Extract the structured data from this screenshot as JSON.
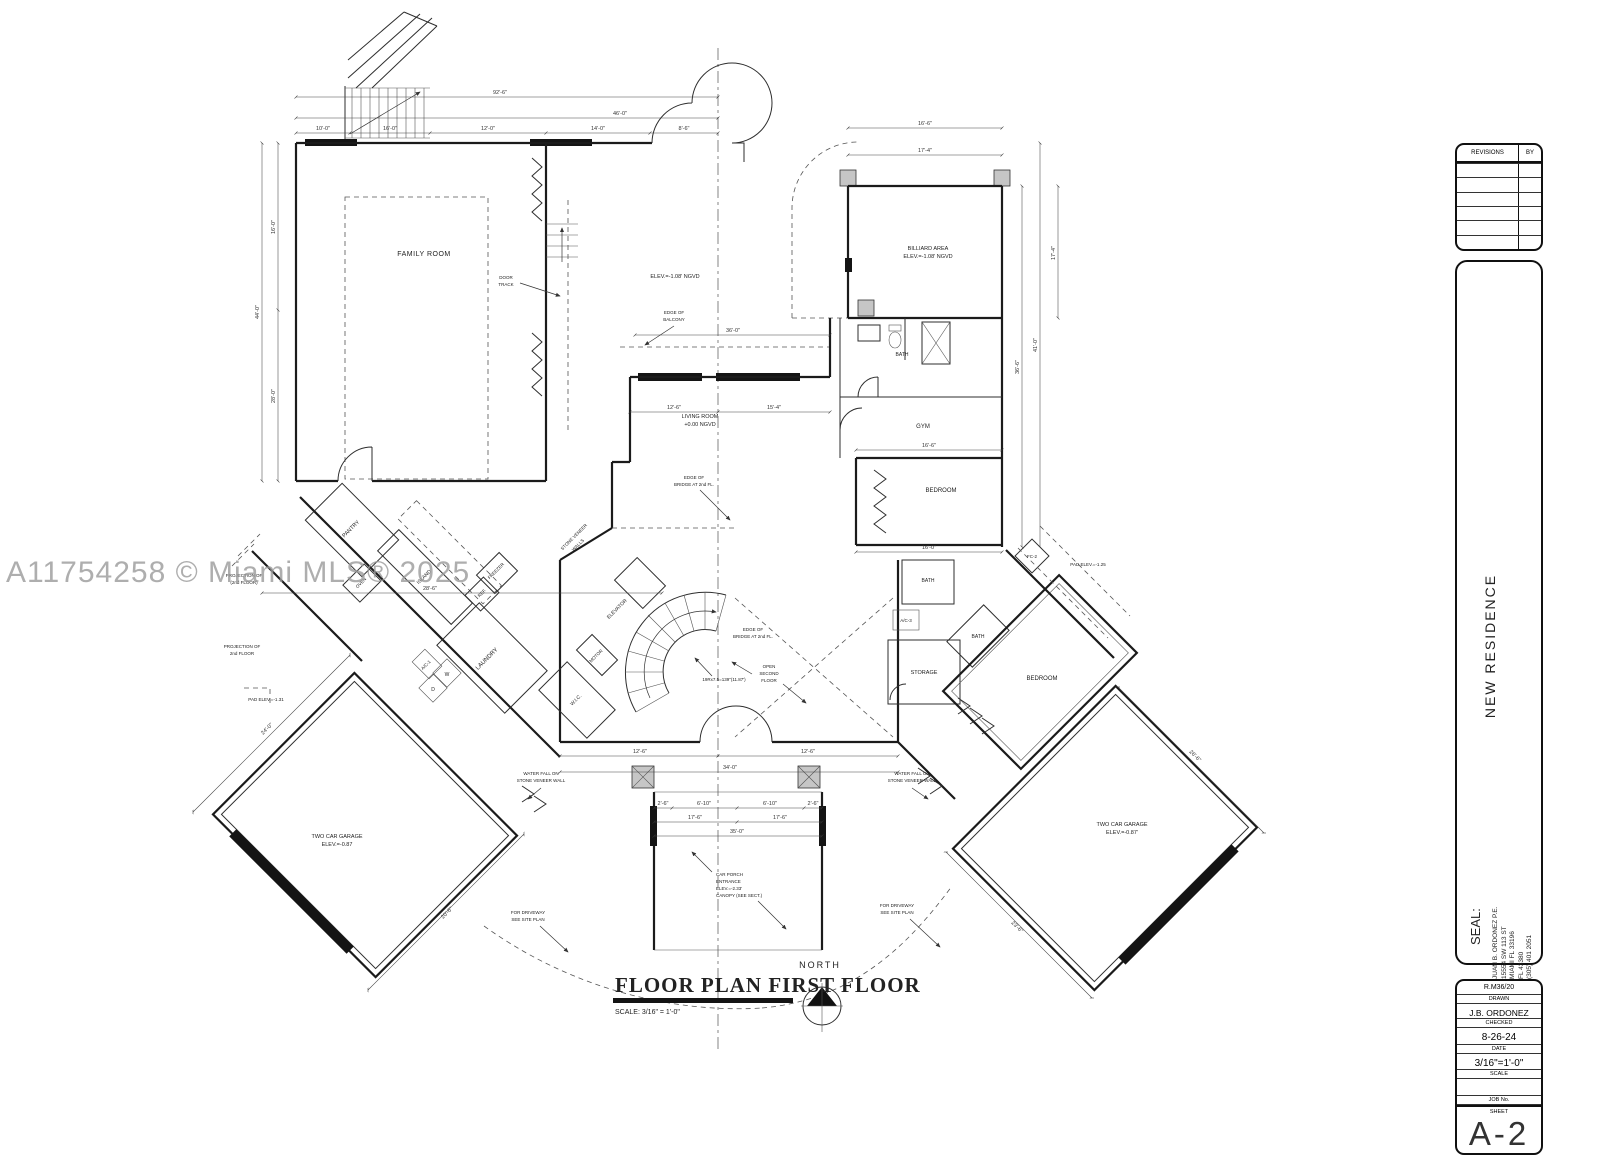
{
  "watermark": "A11754258 © Miami MLS® 2025",
  "plan_title": {
    "main": "FLOOR PLAN FIRST FLOOR",
    "scale": "SCALE: 3/16\" = 1'-0\"",
    "north": "NORTH"
  },
  "titleblock": {
    "revisions_label": "REVISIONS",
    "by_label": "BY",
    "project_name": "NEW RESIDENCE",
    "seal_label": "SEAL:",
    "engineer_lines": [
      "JUAN B. ORDONEZ P.E.",
      "15554 SW 113 ST",
      "MIAMI FL 33196",
      "FL 43380",
      "(305) 401 2051"
    ],
    "drawn_value": "R.M36/20",
    "drawn_label": "DRAWN",
    "checked_value": "J.B. ORDONEZ",
    "checked_label": "CHECKED",
    "date_value": "8-26-24",
    "date_label": "DATE",
    "scale_value": "3/16\"=1'-0\"",
    "scale_label": "SCALE",
    "job_label": "JOB No.",
    "sheet_label": "SHEET",
    "sheet_value": "A-2"
  },
  "rooms": {
    "family": "FAMILY ROOM",
    "living": [
      "LIVING ROOM",
      "+0.00 NGVD"
    ],
    "billiard": [
      "BILLIARD AREA",
      "ELEV.=-1.08' NGVD"
    ],
    "balcony_elev": "ELEV.=-1.08' NGVD",
    "gym": "GYM",
    "bedroom_right": "BEDROOM",
    "bedroom_wing": "BEDROOM",
    "storage": "STORAGE",
    "bath": "BATH",
    "pantry": "PANTRY",
    "island": "ISLAND",
    "oven": "OVEN",
    "freezer": "FREEZER",
    "fridge": "REF.",
    "laundry": "LAUNDRY",
    "wic": "W.I.C.",
    "elevator": "ELEVATOR",
    "motor": "MOTOR",
    "washer": "W",
    "dryer": "D",
    "ac1": "A/C-1",
    "ac3": "A/C-3",
    "fc2": "FC-2",
    "garage_left": [
      "TWO CAR GARAGE",
      "ELEV.=-0.87"
    ],
    "garage_right": [
      "TWO CAR GARAGE",
      "ELEV.=-0.87'"
    ]
  },
  "notes": {
    "door_track": [
      "DOOR",
      "TRACK"
    ],
    "edge_balcony": [
      "EDGE OF",
      "BALCONY"
    ],
    "edge_bridge": [
      "EDGE OF",
      "BRIDGE AT 2nd FL."
    ],
    "open_second": [
      "OPEN",
      "SECOND",
      "FLOOR"
    ],
    "stair_formula": "19Rx7.5=139\"(11.87')",
    "stone_veneer": [
      "STONE VENEER",
      "WALLS"
    ],
    "projection_paren": [
      "PROJECTION OF",
      "(2nd FLOOR)"
    ],
    "projection": [
      "PROJECTION OF",
      "2nd FLOOR"
    ],
    "pad_125": "PAD ELEV.=-1.25",
    "pad_131": "PAD ELEV.=-1.31",
    "waterfall": [
      "WATER FALL ON",
      "STONE VENEER WALL"
    ],
    "driveway": [
      "FOR DRIVEWAY",
      "SEE SITE PLAN"
    ],
    "car_porch": [
      "CAR PORCH",
      "ENTRANCE",
      "ELEV.=-2.33'",
      "CANOPY (SEE SECT.)"
    ]
  },
  "dims": [
    "92'-6\"",
    "46'-0\"",
    "10'-0\"",
    "16'-0\"",
    "12'-0\"",
    "14'-0\"",
    "8'-6\"",
    "16'-6\"",
    "17'-4\"",
    "44'-0\"",
    "16'-0\"",
    "28'-0\"",
    "36'-0\"",
    "12'-6\"",
    "15'-4\"",
    "36'-6\"",
    "41'-0\"",
    "28'-6\"",
    "16'-6\"",
    "16'-0\"",
    "12'-6\"",
    "10'-6\"",
    "12'-6\"",
    "34'-0\"",
    "2'-6\"",
    "6'-10\"",
    "17'-6\"",
    "35'-0\"",
    "24'-0\"",
    "20'-6\"",
    "26'-6\"",
    "23'-6\""
  ]
}
